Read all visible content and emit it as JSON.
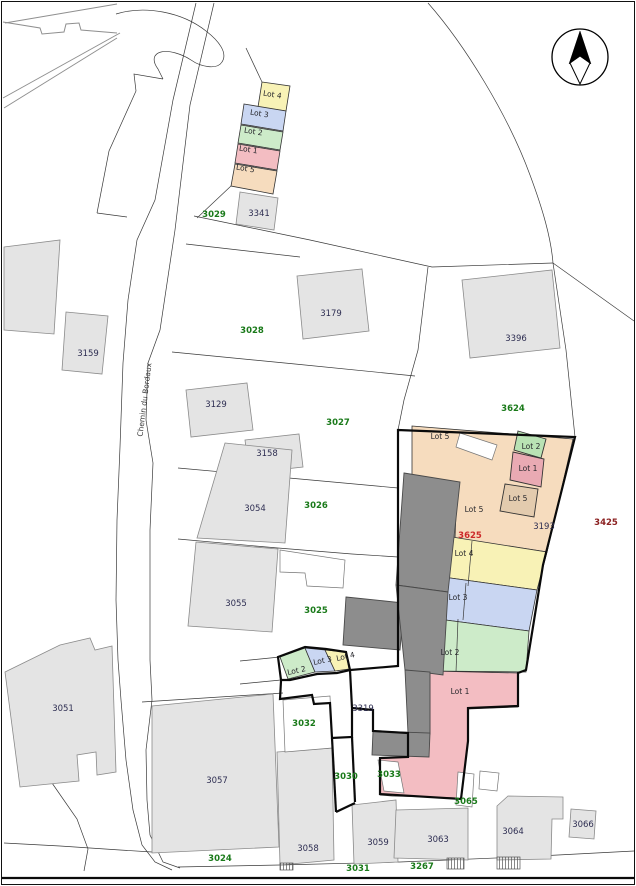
{
  "map": {
    "street_label": "Chemin du Bordaux",
    "colors": {
      "lot1_pink": "#f3bdc2",
      "lot2_green": "#cdebc9",
      "lot3_blue": "#c9d6f2",
      "lot4_yellow": "#f8f2b6",
      "lot5_peach": "#f6dcbe",
      "lot1_bldg_pink": "#e9aab3",
      "lot2_bldg_green": "#b9e2b4",
      "lot5_bldg_tan": "#e3cbae",
      "building_gray": "#e4e4e4",
      "dark_building": "#8d8d8d",
      "parcel_green_text": "#1a7a1a",
      "building_navy_text": "#2e2e52",
      "red_text": "#cc2a2a",
      "maroon_text": "#8b2020"
    },
    "labels": [
      {
        "text": "3029",
        "x": 214,
        "y": 217,
        "kind": "parcel"
      },
      {
        "text": "3028",
        "x": 252,
        "y": 333,
        "kind": "parcel"
      },
      {
        "text": "3027",
        "x": 338,
        "y": 425,
        "kind": "parcel"
      },
      {
        "text": "3624",
        "x": 513,
        "y": 411,
        "kind": "parcel"
      },
      {
        "text": "3026",
        "x": 316,
        "y": 508,
        "kind": "parcel"
      },
      {
        "text": "3025",
        "x": 316,
        "y": 613,
        "kind": "parcel"
      },
      {
        "text": "3032",
        "x": 304,
        "y": 726,
        "kind": "parcel"
      },
      {
        "text": "3030",
        "x": 346,
        "y": 779,
        "kind": "parcel"
      },
      {
        "text": "3033",
        "x": 389,
        "y": 777,
        "kind": "parcel"
      },
      {
        "text": "3024",
        "x": 220,
        "y": 861,
        "kind": "parcel"
      },
      {
        "text": "3031",
        "x": 358,
        "y": 871,
        "kind": "parcel"
      },
      {
        "text": "3267",
        "x": 422,
        "y": 869,
        "kind": "parcel"
      },
      {
        "text": "3065",
        "x": 466,
        "y": 804,
        "kind": "parcel"
      },
      {
        "text": "3341",
        "x": 259,
        "y": 216,
        "kind": "building"
      },
      {
        "text": "3159",
        "x": 88,
        "y": 356,
        "kind": "building"
      },
      {
        "text": "3179",
        "x": 331,
        "y": 316,
        "kind": "building"
      },
      {
        "text": "3129",
        "x": 216,
        "y": 407,
        "kind": "building"
      },
      {
        "text": "3158",
        "x": 267,
        "y": 456,
        "kind": "building"
      },
      {
        "text": "3396",
        "x": 516,
        "y": 341,
        "kind": "building"
      },
      {
        "text": "3054",
        "x": 255,
        "y": 511,
        "kind": "building"
      },
      {
        "text": "3055",
        "x": 236,
        "y": 606,
        "kind": "building"
      },
      {
        "text": "3051",
        "x": 63,
        "y": 711,
        "kind": "building"
      },
      {
        "text": "3057",
        "x": 217,
        "y": 783,
        "kind": "building"
      },
      {
        "text": "3058",
        "x": 308,
        "y": 851,
        "kind": "building"
      },
      {
        "text": "3059",
        "x": 378,
        "y": 845,
        "kind": "building"
      },
      {
        "text": "3063",
        "x": 438,
        "y": 842,
        "kind": "building"
      },
      {
        "text": "3064",
        "x": 513,
        "y": 834,
        "kind": "building"
      },
      {
        "text": "3066",
        "x": 583,
        "y": 827,
        "kind": "building"
      },
      {
        "text": "3319",
        "x": 363,
        "y": 711,
        "kind": "building"
      },
      {
        "text": "3193",
        "x": 544,
        "y": 529,
        "kind": "building"
      },
      {
        "text": "3625",
        "x": 470,
        "y": 538,
        "kind": "red"
      },
      {
        "text": "3425",
        "x": 606,
        "y": 525,
        "kind": "maroon"
      },
      {
        "text": "Lot 4",
        "x": 272,
        "y": 97,
        "kind": "lot",
        "rot": 9
      },
      {
        "text": "Lot 3",
        "x": 259,
        "y": 116,
        "kind": "lot",
        "rot": 9
      },
      {
        "text": "Lot 2",
        "x": 253,
        "y": 134,
        "kind": "lot",
        "rot": 9
      },
      {
        "text": "Lot 1",
        "x": 248,
        "y": 152,
        "kind": "lot",
        "rot": 9
      },
      {
        "text": "Lot 5",
        "x": 245,
        "y": 171,
        "kind": "lot",
        "rot": 9
      },
      {
        "text": "Lot 5",
        "x": 440,
        "y": 439,
        "kind": "lot"
      },
      {
        "text": "Lot 2",
        "x": 531,
        "y": 449,
        "kind": "lot"
      },
      {
        "text": "Lot 1",
        "x": 528,
        "y": 471,
        "kind": "lot"
      },
      {
        "text": "Lot 5",
        "x": 518,
        "y": 501,
        "kind": "lot"
      },
      {
        "text": "Lot 5",
        "x": 474,
        "y": 512,
        "kind": "lot"
      },
      {
        "text": "Lot 4",
        "x": 464,
        "y": 556,
        "kind": "lot"
      },
      {
        "text": "Lot 3",
        "x": 458,
        "y": 600,
        "kind": "lot"
      },
      {
        "text": "Lot 2",
        "x": 450,
        "y": 655,
        "kind": "lot"
      },
      {
        "text": "Lot 1",
        "x": 460,
        "y": 694,
        "kind": "lot"
      },
      {
        "text": "Lot 2",
        "x": 297,
        "y": 673,
        "kind": "lot",
        "rot": -12
      },
      {
        "text": "Lot 3",
        "x": 323,
        "y": 663,
        "kind": "lot",
        "rot": -12
      },
      {
        "text": "Lot 4",
        "x": 346,
        "y": 659,
        "kind": "lot",
        "rot": -12
      },
      {
        "text": "Chemin du Bordaux",
        "x": 147,
        "y": 400,
        "kind": "street",
        "rot": -83
      }
    ]
  }
}
